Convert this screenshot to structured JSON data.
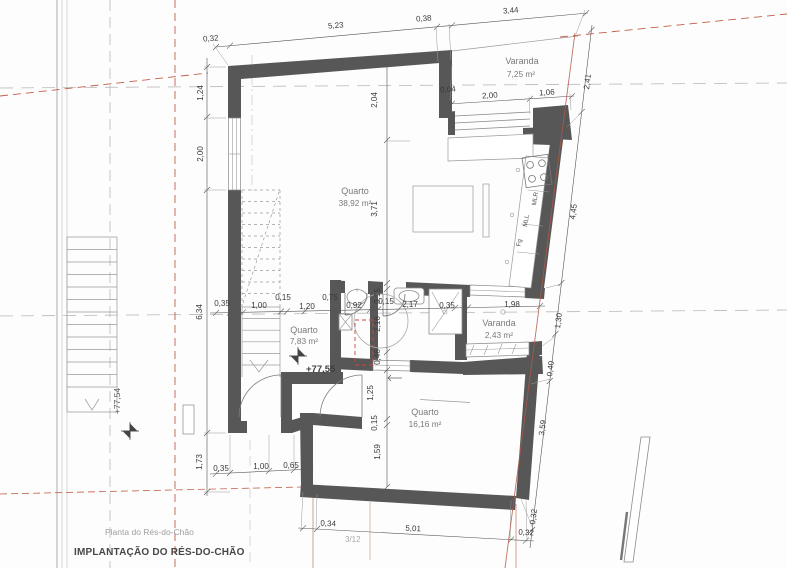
{
  "drawing": {
    "title": "IMPLANTAÇÃO DO RÉS-DO-CHÃO",
    "subtitle": "Planta do Rés-do-Chão",
    "sheet_ref": "3/12"
  },
  "rooms": {
    "quarto_main": {
      "name": "Quarto",
      "area": "38,92 m²"
    },
    "varanda_top": {
      "name": "Varanda",
      "area": "7,25 m²"
    },
    "quarto_small": {
      "name": "Quarto",
      "area": "7,83 m²"
    },
    "varanda_side": {
      "name": "Varanda",
      "area": "2,43 m²"
    },
    "quarto_bottom": {
      "name": "Quarto",
      "area": "16,16 m²"
    }
  },
  "levels": {
    "interior": "+77,55",
    "exterior": "+77,54"
  },
  "appliances": {
    "mlr": "MLR",
    "mll": "MLL",
    "fg": "Fg"
  },
  "dims": {
    "top": [
      "0,32",
      "5,23",
      "0,38",
      "3,44"
    ],
    "top_right": [
      "0,04",
      "2,00",
      "1,06"
    ],
    "left": [
      "1,24",
      "2,00",
      "6,34",
      "1,73"
    ],
    "right": [
      "2,41",
      "4,45",
      "1,30",
      "0,40",
      "3,59",
      "0,32"
    ],
    "center": [
      "2,04",
      "3,71"
    ],
    "mid_chain": [
      "0,35",
      "1,00",
      "0,15",
      "1,20",
      "0,75",
      "0,92",
      "0,15",
      "2,17",
      "0,35",
      "1,98"
    ],
    "bath_col": [
      "0,15",
      "2,16",
      "0,46"
    ],
    "south_col": [
      "1,25",
      "0,15",
      "1,59"
    ],
    "bottom_left": [
      "0,35",
      "1,00",
      "0,65"
    ],
    "bottom": [
      "0,34",
      "5,01",
      "0,32"
    ]
  },
  "colors": {
    "wall_gray": "#575757",
    "construction_red": "#b95f4c",
    "construction_gray": "#b3b3b3",
    "demolition_red": "#cc4437"
  }
}
